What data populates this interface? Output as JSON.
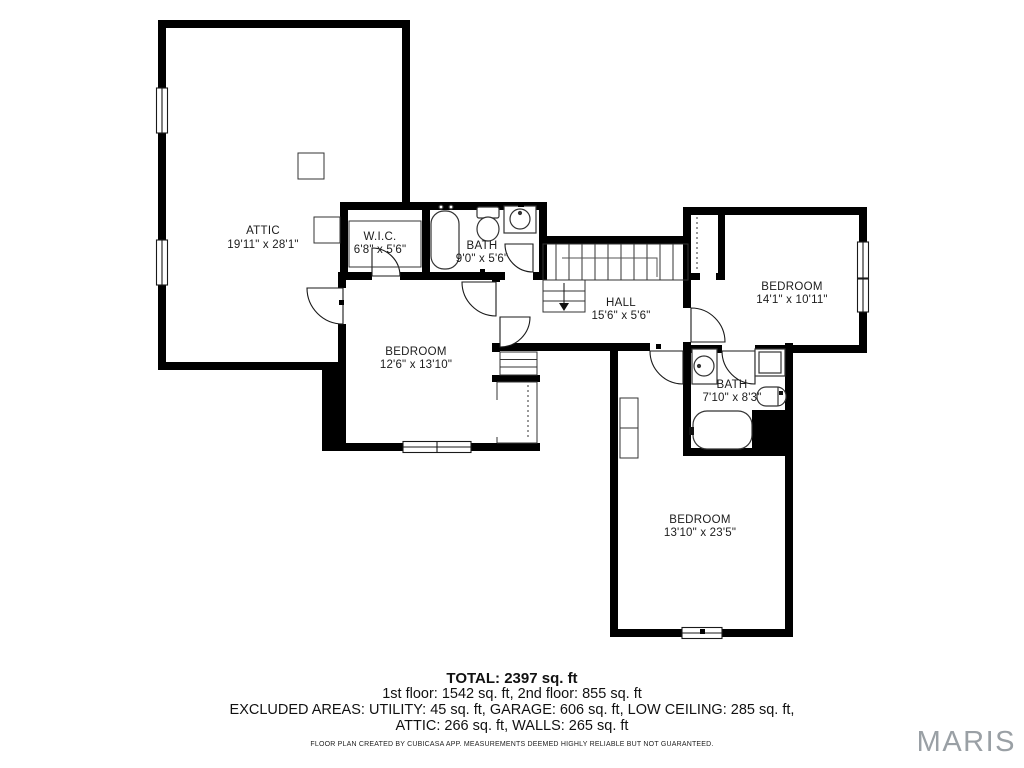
{
  "rooms": {
    "attic": {
      "name": "ATTIC",
      "dims": "19'11\" x 28'1\""
    },
    "wic": {
      "name": "W.I.C.",
      "dims": "6'8\" x 5'6\""
    },
    "bath1": {
      "name": "BATH",
      "dims": "9'0\" x 5'6\""
    },
    "hall": {
      "name": "HALL",
      "dims": "15'6\" x 5'6\""
    },
    "bedroom_left": {
      "name": "BEDROOM",
      "dims": "12'6\" x 13'10\""
    },
    "bedroom_right": {
      "name": "BEDROOM",
      "dims": "14'1\" x 10'11\""
    },
    "bath2": {
      "name": "BATH",
      "dims": "7'10\" x 8'3\""
    },
    "bedroom_bottom": {
      "name": "BEDROOM",
      "dims": "13'10\" x 23'5\""
    }
  },
  "summary": {
    "total": "TOTAL: 2397 sq. ft",
    "floors": "1st floor: 1542 sq. ft, 2nd floor: 855 sq. ft",
    "excluded_line1": "EXCLUDED AREAS: UTILITY: 45 sq. ft, GARAGE: 606 sq. ft, LOW CEILING: 285 sq. ft,",
    "excluded_line2": "ATTIC: 266 sq. ft, WALLS: 265 sq. ft",
    "disclaimer": "FLOOR PLAN CREATED BY CUBICASA APP. MEASUREMENTS DEEMED HIGHLY RELIABLE BUT NOT GUARANTEED."
  },
  "branding": {
    "logo": "MARIS"
  },
  "colors": {
    "wall": "#000000",
    "text": "#1c1c1c",
    "logo_gray": "#9aa0a5"
  }
}
